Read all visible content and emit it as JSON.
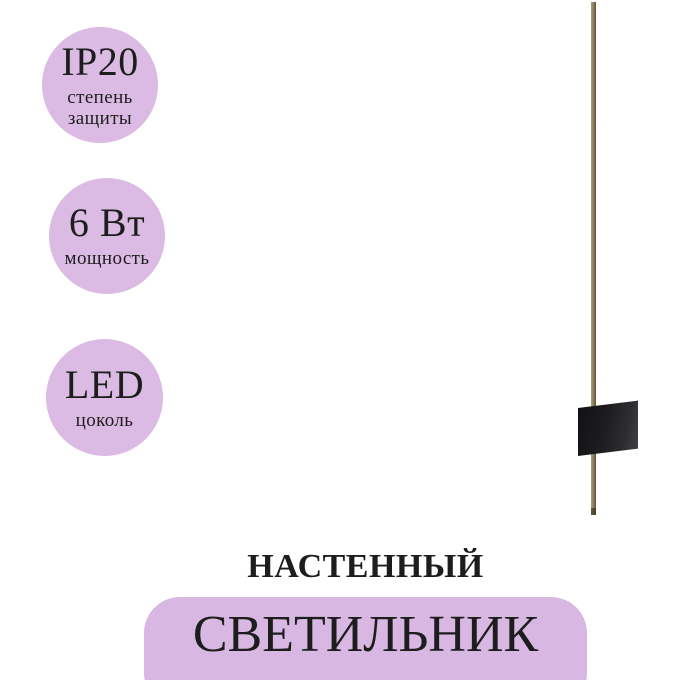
{
  "badges": [
    {
      "value": "IP20",
      "line1": "степень",
      "line2": "защиты"
    },
    {
      "value": "6 Вт",
      "line1": "мощность",
      "line2": ""
    },
    {
      "value": "LED",
      "line1": "цоколь",
      "line2": ""
    }
  ],
  "product": {
    "type_label": "НАСТЕННЫЙ",
    "name_label": "СВЕТИЛЬНИК"
  },
  "lamp": {
    "name": "wall-lamp"
  },
  "colors": {
    "badge_bg": "#dbbae4",
    "panel_bg": "#d8b7e2",
    "text_dark": "#1d1d1d",
    "rod_light": "#ac9c7c",
    "rod_mid": "#8a7a5c",
    "rod_dark": "#5e5136",
    "mount_dark": "#121214",
    "mount_light": "#404045"
  }
}
